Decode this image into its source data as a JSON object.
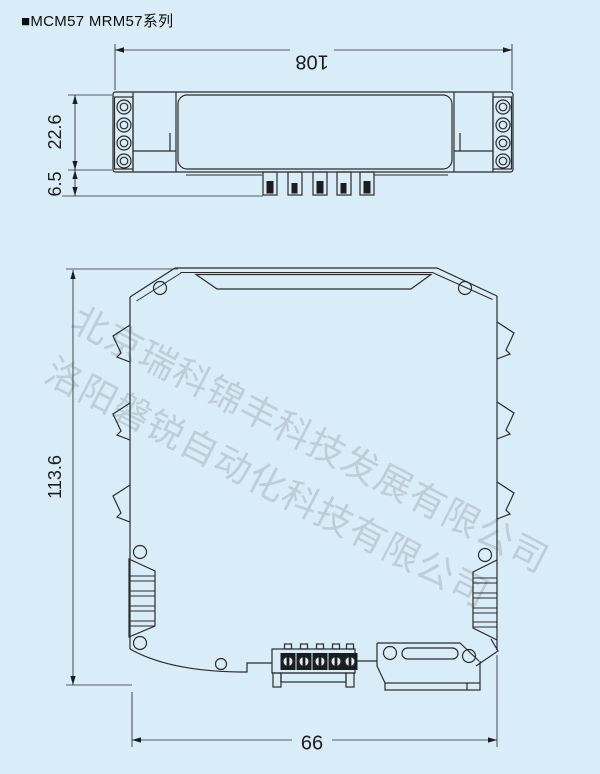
{
  "title": "■MCM57 MRM57系列",
  "colors": {
    "background": "#d9edf8",
    "line": "#2b2b2b",
    "watermark": "#9aa4ab",
    "fill_dark": "#1c1c1c"
  },
  "top_view": {
    "name": "top-view-drawing",
    "dims": {
      "width": "108",
      "body_height": "22.6",
      "pin_depth": "6.5"
    },
    "features": {
      "terminal_circles_per_side": 4,
      "bottom_pins": 5
    }
  },
  "side_view": {
    "name": "side-view-drawing",
    "dims": {
      "height": "113.6",
      "width": "66"
    },
    "features": {
      "side_clips_per_edge": 3,
      "front_terminal_screws": 5
    }
  },
  "watermarks": [
    "北京瑞科锦丰科技发展有限公司",
    "洛阳磐锐自动化科技有限公司"
  ]
}
